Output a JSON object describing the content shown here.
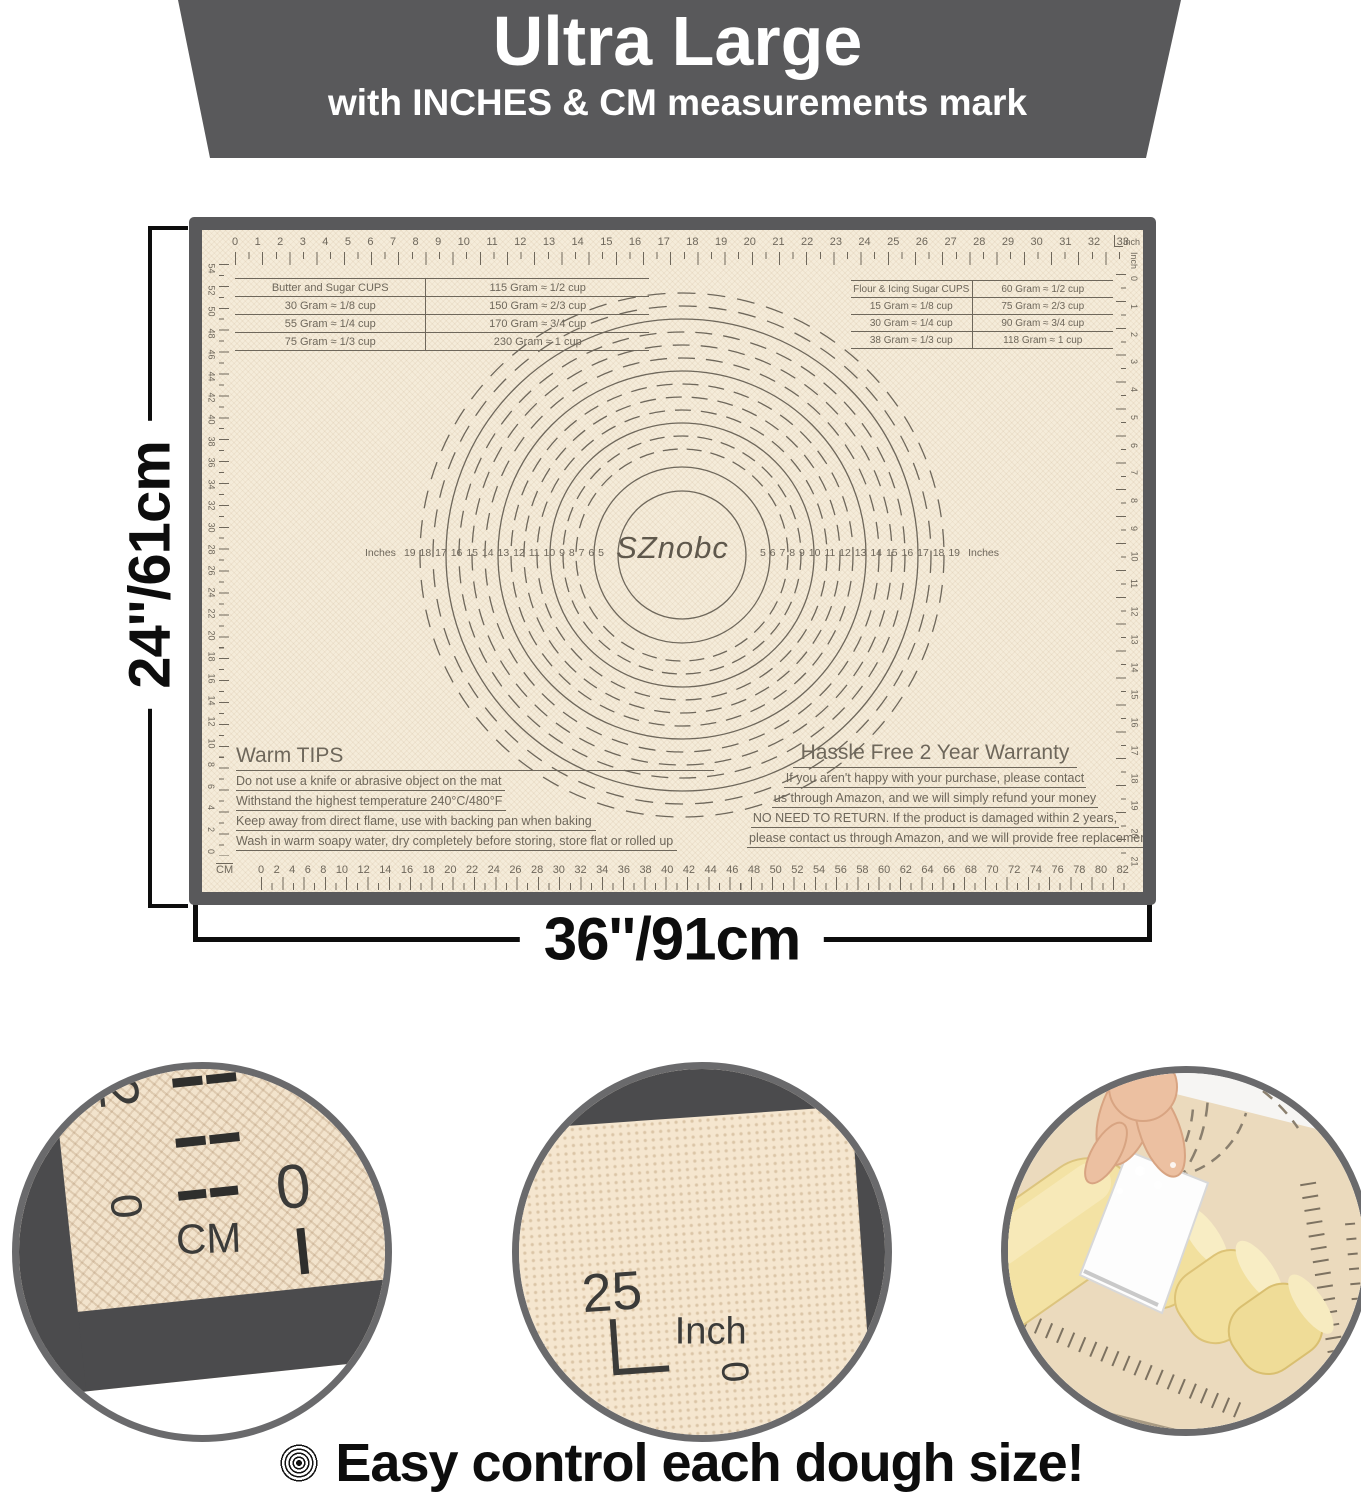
{
  "banner": {
    "title": "Ultra Large",
    "subtitle": "with INCHES & CM measurements mark"
  },
  "dimensions": {
    "height_label": "24''/61cm",
    "width_label": "36''/91cm"
  },
  "mat": {
    "brand": "SZnobc",
    "top_ruler_unit": "Inch",
    "top_ruler_numbers": [
      0,
      1,
      2,
      3,
      4,
      5,
      6,
      7,
      8,
      9,
      10,
      11,
      12,
      13,
      14,
      15,
      16,
      17,
      18,
      19,
      20,
      21,
      22,
      23,
      24,
      25,
      26,
      27,
      28,
      29,
      30,
      31,
      32,
      33
    ],
    "bottom_ruler_unit": "CM",
    "bottom_ruler_numbers": [
      0,
      2,
      4,
      6,
      8,
      10,
      12,
      14,
      16,
      18,
      20,
      22,
      24,
      26,
      28,
      30,
      32,
      34,
      36,
      38,
      40,
      42,
      44,
      46,
      48,
      50,
      52,
      54,
      56,
      58,
      60,
      62,
      64,
      66,
      68,
      70,
      72,
      74,
      76,
      78,
      80,
      82
    ],
    "left_ruler_numbers": [
      54,
      52,
      50,
      48,
      46,
      44,
      42,
      40,
      38,
      36,
      34,
      32,
      30,
      28,
      26,
      24,
      22,
      20,
      18,
      16,
      14,
      12,
      10,
      8,
      6,
      4,
      2,
      0
    ],
    "right_ruler_unit": "Inch",
    "right_ruler_numbers": [
      0,
      1,
      2,
      3,
      4,
      5,
      6,
      7,
      8,
      9,
      10,
      11,
      12,
      13,
      14,
      15,
      16,
      17,
      18,
      19,
      20,
      21
    ],
    "circle_unit_label": "Inches",
    "circle_numbers_left": [
      19,
      18,
      17,
      16,
      15,
      14,
      13,
      12,
      11,
      10,
      9,
      8,
      7,
      6,
      5
    ],
    "circle_numbers_right": [
      5,
      6,
      7,
      8,
      9,
      10,
      11,
      12,
      13,
      14,
      15,
      16,
      17,
      18,
      19
    ],
    "butter_table": {
      "rows": [
        [
          "Butter and Sugar CUPS",
          "115 Gram ≈ 1/2 cup"
        ],
        [
          "30 Gram ≈ 1/8 cup",
          "150 Gram ≈ 2/3 cup"
        ],
        [
          "55 Gram ≈ 1/4 cup",
          "170 Gram ≈ 3/4 cup"
        ],
        [
          "75 Gram ≈ 1/3 cup",
          "230 Gram ≈ 1 cup"
        ]
      ]
    },
    "flour_table": {
      "rows": [
        [
          "Flour & Icing Sugar CUPS",
          "60 Gram ≈ 1/2 cup"
        ],
        [
          "15 Gram ≈ 1/8 cup",
          "75 Gram ≈ 2/3 cup"
        ],
        [
          "30 Gram ≈ 1/4 cup",
          "90 Gram ≈ 3/4 cup"
        ],
        [
          "38 Gram ≈ 1/3 cup",
          "118 Gram ≈ 1 cup"
        ]
      ]
    },
    "warm_tips": {
      "title": "Warm TIPS",
      "lines": [
        "Do not use a knife or abrasive object on the mat",
        "Withstand the highest temperature 240°C/480°F",
        "Keep away from direct flame, use with backing pan when baking",
        "Wash in warm soapy water, dry completely before storing, store flat or rolled up"
      ]
    },
    "warranty": {
      "title": "Hassle Free 2 Year Warranty",
      "lines": [
        "If you aren't happy with your purchase, please contact",
        "us through Amazon,  and we will simply refund your money",
        "NO NEED TO RETURN. If the product is damaged within 2 years,",
        "please contact us through Amazon, and we will provide free replacements."
      ]
    }
  },
  "details": {
    "cm_corner": {
      "two": "2",
      "zero_side": "0",
      "cm": "CM",
      "zero_bottom": "0"
    },
    "inch_corner": {
      "twentyfive": "25",
      "inch": "Inch",
      "zero": "0"
    }
  },
  "caption": {
    "text": "Easy control each dough size!"
  },
  "colors": {
    "frame_gray": "#59595b",
    "mat_beige": "#f5ecda",
    "marking_ink": "#6e675b",
    "label_black": "#0d0d0d",
    "dough_yellow": "#f3e2a4"
  }
}
